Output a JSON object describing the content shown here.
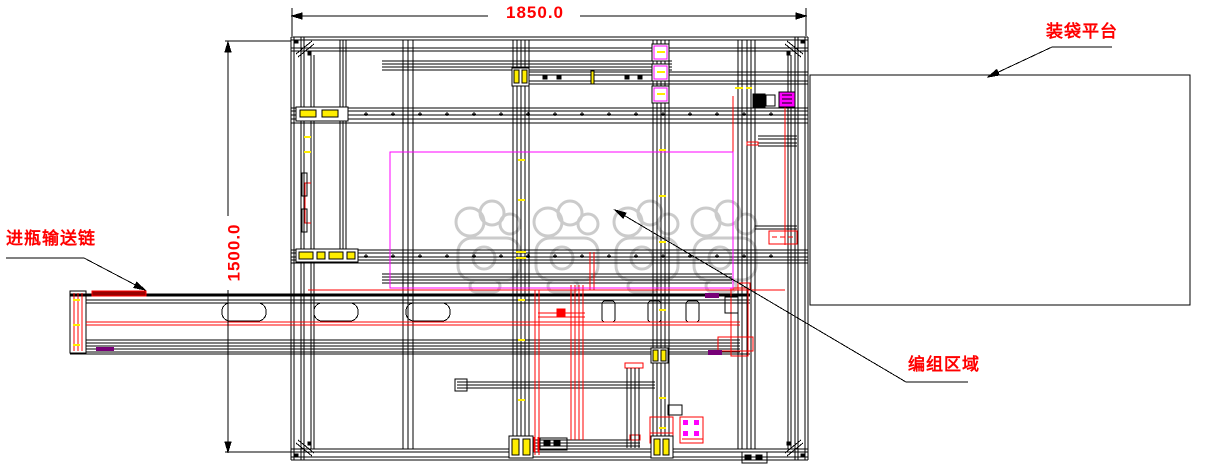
{
  "drawing": {
    "dimensions": {
      "top_width": "1850.0",
      "left_height": "1500.0"
    },
    "labels": {
      "bagging_platform": "装袋平台",
      "bottle_infeed_conveyor": "进瓶输送链",
      "grouping_area": "编组区域"
    },
    "colors": {
      "line_black": "#000000",
      "annotation_red": "#ff0000",
      "accent_magenta": "#ff00ff",
      "accent_yellow": "#ffee00",
      "accent_purple": "#770077",
      "watermark_gray": "#c9c9c9",
      "background": "#ffffff"
    },
    "watermark": {
      "char_count": 4,
      "style": "gray outlined stylized characters"
    }
  }
}
